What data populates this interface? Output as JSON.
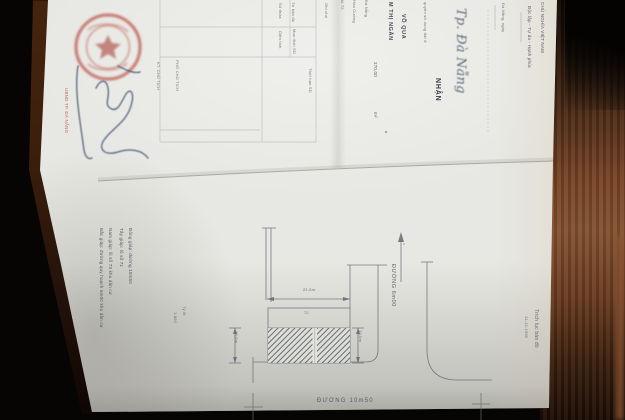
{
  "colors": {
    "background": "#070503",
    "paper": "#e7e8e3",
    "wood": "#7a4628",
    "seal_red": "#b5473f",
    "signature_ink": "#4a5a78",
    "pencil": "#646a73"
  },
  "certificate": {
    "motto_line_1": "CHỦ NGHĨA VIỆT NAM",
    "motto_line_2": "Độc lập - Tự do - Hạnh phúc",
    "date_line": "Đà Nẵng, ngày",
    "handwritten_place": "Tp. Đà Nẵng",
    "heading_word": "NHẬN",
    "intro_line": "quyền sử dụng đất ở",
    "owner_name_1": "VÕ QUA",
    "owner_name_2": "M THỊ NGÂN",
    "area_value": "270,00",
    "area_unit": "m²",
    "address_frag_1": "lô 72",
    "address_frag_2": "Hòa Cường",
    "address_frag_3": "Đà Nẵng"
  },
  "registry_table": {
    "labels": [
      "Số thửa",
      "Tờ bản đồ",
      "Diện tích",
      "Mục đích SD",
      "Thời hạn SD",
      "Ghi chú"
    ]
  },
  "seal_block": {
    "red_note": "UBND TP. ĐÀ NẴNG",
    "title_line_1": "KT. CHỦ TỊCH",
    "title_line_2": "PHÓ CHỦ TỊCH"
  },
  "map": {
    "title": "Trích lục bản đồ",
    "date": "11-12-1990",
    "lot_number": "72",
    "dim_top": "21,0m",
    "dim_left": "13,0m",
    "dim_right": "13,0m",
    "road_vertical": "ĐƯỜNG 6m00",
    "road_bottom": "ĐƯỜNG 10m50",
    "scale_label": "Tỷ lệ",
    "scale_value": "1:500",
    "boundary_notes": [
      "Đông giáp: đường 10m50",
      "Tây giáp: lô số 71",
      "Nam giáp: lô số 73 khu dân cư",
      "Bắc giáp: đường quy hoạch 6m00 khu dân cư"
    ]
  }
}
